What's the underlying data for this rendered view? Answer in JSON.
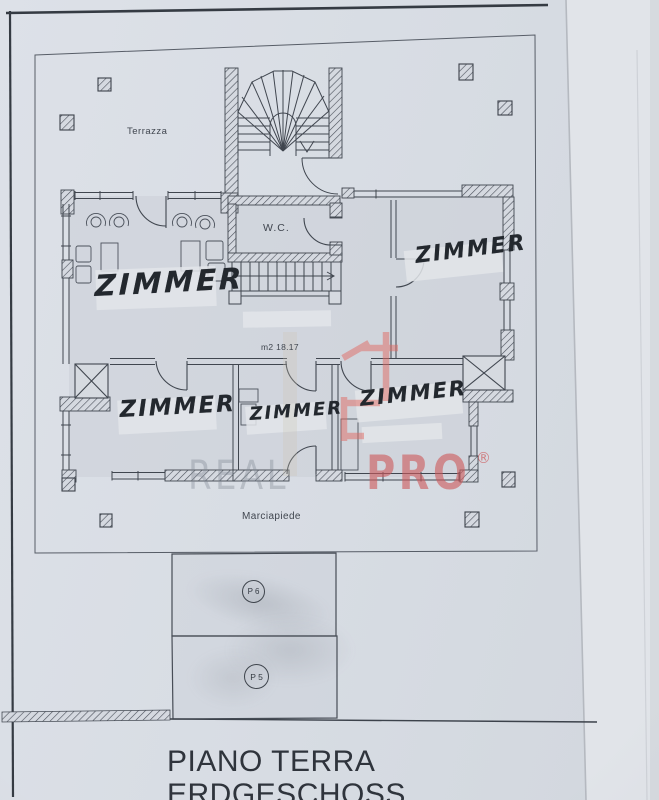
{
  "labels": {
    "terrace": "Terrazza",
    "wc": "W.C.",
    "area_note": "m2 18.17",
    "sidewalk": "Marciapiede"
  },
  "rooms": {
    "living": "ZIMMER",
    "top_right": "ZIMMER",
    "bottom_left": "ZIMMER",
    "bottom_middle": "ZIMMER",
    "bottom_right": "ZIMMER"
  },
  "parking": {
    "p6": "P 6",
    "p5": "P 5"
  },
  "watermark": {
    "gray": "REAL",
    "red": "PRO",
    "registered": "®",
    "gray_color": "#8e949d",
    "red_color": "#cf6165"
  },
  "title": {
    "line1": "PIANO TERRA",
    "line2": "ERDGESCHOSS"
  },
  "colors": {
    "paper": "#d8dce3",
    "ink": "#40464f",
    "handwriting": "#23282e",
    "accent_red": "#e06a64"
  }
}
